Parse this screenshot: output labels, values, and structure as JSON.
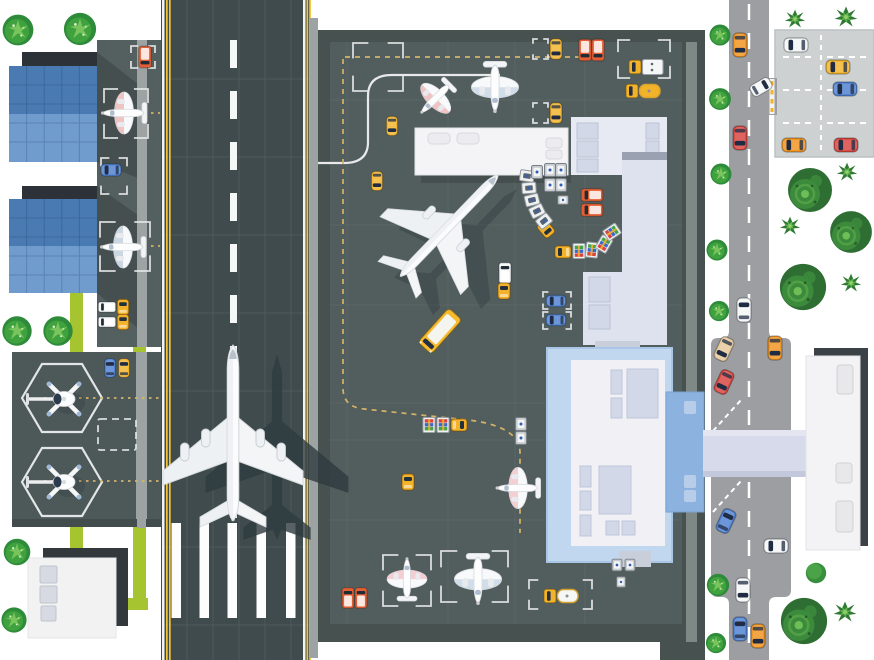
{
  "palette": {
    "bg": "#ffffff",
    "runway": "#3f4b4d",
    "runwayLine": "#4e5a5b",
    "runwayEdgeWhite": "#f2f3f3",
    "runwayEdgeYellow": "#f2c335",
    "apron": "#525d5d",
    "apronDark": "#47514f",
    "apronGrid": "#5d6868",
    "apronStrip": "#9da3a3",
    "pad": "#4d5859",
    "hangarRoofTop": "#4a7ab2",
    "hangarRoofBottom": "#6f9ccd",
    "hangarDark": "#2c3237",
    "lime": "#a6c430",
    "road": "#9c9ea1",
    "parking": "#cdd1d1",
    "terminal": "#e7eaf2",
    "terminalWing": "#dde2ee",
    "roofDetail": "#d2d8e7",
    "glass": "#c0d7ef",
    "atrium": "#8cb2e0",
    "bridge": "#d6daea",
    "shadowDark": "#3a4147",
    "marking": "#e8eaea",
    "taxiDash": "#d5b469",
    "vehicle": {
      "blue": "#4d7fd0",
      "yellow": "#f2b32a",
      "orange": "#f2921d",
      "red": "#d8433c",
      "orangeRed": "#e45e33",
      "white": "#f5f6f6",
      "tan": "#e6c79a",
      "busYellow": "#f6bb2e"
    }
  },
  "scene": {
    "trees": [
      {
        "k": "bush",
        "x": 18,
        "y": 30,
        "s": 1.1
      },
      {
        "k": "bush",
        "x": 80,
        "y": 29,
        "s": 1.15
      },
      {
        "k": "bush",
        "x": 17,
        "y": 331,
        "s": 1.05
      },
      {
        "k": "bush",
        "x": 58,
        "y": 331,
        "s": 1.05
      },
      {
        "k": "bush",
        "x": 17,
        "y": 552,
        "s": 0.95
      },
      {
        "k": "bush",
        "x": 14,
        "y": 620,
        "s": 0.9
      },
      {
        "k": "bush",
        "x": 720,
        "y": 35,
        "s": 0.75
      },
      {
        "k": "bush",
        "x": 720,
        "y": 99,
        "s": 0.78
      },
      {
        "k": "bush",
        "x": 721,
        "y": 174,
        "s": 0.75
      },
      {
        "k": "bush",
        "x": 717,
        "y": 250,
        "s": 0.75
      },
      {
        "k": "bush",
        "x": 719,
        "y": 311,
        "s": 0.72
      },
      {
        "k": "bush",
        "x": 718,
        "y": 585,
        "s": 0.8
      },
      {
        "k": "bush",
        "x": 716,
        "y": 643,
        "s": 0.72
      },
      {
        "k": "palm",
        "x": 795,
        "y": 19,
        "s": 0.85
      },
      {
        "k": "palm",
        "x": 846,
        "y": 17,
        "s": 0.95
      },
      {
        "k": "palm",
        "x": 847,
        "y": 172,
        "s": 0.85
      },
      {
        "k": "palm",
        "x": 790,
        "y": 226,
        "s": 0.85
      },
      {
        "k": "palm",
        "x": 851,
        "y": 283,
        "s": 0.85
      },
      {
        "k": "palm",
        "x": 845,
        "y": 612,
        "s": 0.95
      },
      {
        "k": "big",
        "x": 810,
        "y": 190,
        "s": 1
      },
      {
        "k": "big",
        "x": 851,
        "y": 232,
        "s": 0.95
      },
      {
        "k": "big",
        "x": 803,
        "y": 287,
        "s": 1.05
      },
      {
        "k": "big",
        "x": 804,
        "y": 621,
        "s": 1.05
      },
      {
        "k": "round",
        "x": 816,
        "y": 573,
        "s": 0.85
      }
    ],
    "vehicles": [
      {
        "k": "car",
        "x": 740,
        "y": 45,
        "r": 180,
        "c": "orange"
      },
      {
        "k": "car",
        "x": 740,
        "y": 138,
        "r": 180,
        "c": "red"
      },
      {
        "k": "car",
        "x": 744,
        "y": 310,
        "r": 0,
        "c": "white"
      },
      {
        "k": "car",
        "x": 724,
        "y": 349,
        "r": 205,
        "c": "tan"
      },
      {
        "k": "car",
        "x": 775,
        "y": 348,
        "r": 180,
        "c": "orange"
      },
      {
        "k": "car",
        "x": 724,
        "y": 382,
        "r": 205,
        "c": "red"
      },
      {
        "k": "car",
        "x": 726,
        "y": 521,
        "r": 25,
        "c": "blue"
      },
      {
        "k": "car",
        "x": 776,
        "y": 546,
        "r": 270,
        "c": "white"
      },
      {
        "k": "car",
        "x": 743,
        "y": 590,
        "r": 180,
        "c": "white"
      },
      {
        "k": "car",
        "x": 740,
        "y": 629,
        "r": 0,
        "c": "blue"
      },
      {
        "k": "car",
        "x": 758,
        "y": 636,
        "r": 180,
        "c": "orange"
      },
      {
        "k": "car",
        "x": 796,
        "y": 45,
        "r": 270,
        "c": "white"
      },
      {
        "k": "car",
        "x": 838,
        "y": 67,
        "r": 270,
        "c": "yellow"
      },
      {
        "k": "car",
        "x": 845,
        "y": 89,
        "r": 270,
        "c": "blue"
      },
      {
        "k": "car",
        "x": 794,
        "y": 145,
        "r": 270,
        "c": "orange"
      },
      {
        "k": "car",
        "x": 846,
        "y": 145,
        "r": 270,
        "c": "red"
      },
      {
        "k": "car",
        "x": 761,
        "y": 87,
        "r": 60,
        "c": "white",
        "s": 0.9
      },
      {
        "k": "car",
        "x": 110,
        "y": 368,
        "r": 0,
        "c": "blue",
        "s": 0.78
      },
      {
        "k": "car",
        "x": 124,
        "y": 368,
        "r": 0,
        "c": "yellow",
        "s": 0.78
      },
      {
        "k": "van",
        "x": 145,
        "y": 57,
        "r": 180,
        "c": "orangeRed",
        "s": 0.9
      },
      {
        "k": "car",
        "x": 111,
        "y": 170,
        "r": 270,
        "c": "blue",
        "s": 0.85
      },
      {
        "k": "van",
        "x": 107,
        "y": 307,
        "r": 270,
        "c": "white",
        "s": 0.72
      },
      {
        "k": "tug",
        "x": 123,
        "y": 307,
        "r": 0,
        "c": "yellow",
        "s": 0.95
      },
      {
        "k": "van",
        "x": 107,
        "y": 322,
        "r": 270,
        "c": "white",
        "s": 0.72
      },
      {
        "k": "tug",
        "x": 123,
        "y": 322,
        "r": 0,
        "c": "yellow",
        "s": 0.95
      },
      {
        "k": "car",
        "x": 392,
        "y": 126,
        "r": 180,
        "c": "yellow",
        "s": 0.8
      },
      {
        "k": "car",
        "x": 377,
        "y": 181,
        "r": 180,
        "c": "yellow",
        "s": 0.8
      },
      {
        "k": "car",
        "x": 556,
        "y": 49,
        "r": 180,
        "c": "yellow",
        "s": 0.85
      },
      {
        "k": "car",
        "x": 556,
        "y": 113,
        "r": 180,
        "c": "yellow",
        "s": 0.85
      },
      {
        "k": "van",
        "x": 585,
        "y": 50,
        "r": 180,
        "c": "orangeRed",
        "s": 0.9
      },
      {
        "k": "van",
        "x": 598,
        "y": 50,
        "r": 180,
        "c": "orangeRed",
        "s": 0.9
      },
      {
        "k": "van",
        "x": 592,
        "y": 195,
        "r": 270,
        "c": "orangeRed",
        "s": 0.9
      },
      {
        "k": "van",
        "x": 592,
        "y": 210,
        "r": 270,
        "c": "orangeRed",
        "s": 0.9
      },
      {
        "k": "car",
        "x": 556,
        "y": 301,
        "r": 270,
        "c": "blue",
        "s": 0.82
      },
      {
        "k": "car",
        "x": 556,
        "y": 320,
        "r": 270,
        "c": "blue",
        "s": 0.82
      },
      {
        "k": "van",
        "x": 505,
        "y": 273,
        "r": 0,
        "c": "white",
        "s": 0.85
      },
      {
        "k": "tug",
        "x": 504,
        "y": 291,
        "r": 0,
        "c": "yellow"
      },
      {
        "k": "van",
        "x": 348,
        "y": 598,
        "r": 0,
        "c": "orangeRed",
        "s": 0.85
      },
      {
        "k": "van",
        "x": 361,
        "y": 598,
        "r": 0,
        "c": "orangeRed",
        "s": 0.85
      },
      {
        "k": "tug",
        "x": 408,
        "y": 482,
        "r": 0,
        "c": "yellow"
      },
      {
        "k": "bus",
        "x": 440,
        "y": 331,
        "r": 222,
        "c": "busYellow"
      },
      {
        "k": "truckBox",
        "x": 646,
        "y": 67,
        "r": 270,
        "c": "white"
      },
      {
        "k": "truckTank",
        "x": 643,
        "y": 91,
        "r": 270,
        "c": "yellow"
      },
      {
        "k": "truckTank",
        "x": 561,
        "y": 596,
        "r": 270,
        "c": "white"
      },
      {
        "k": "tug",
        "x": 546,
        "y": 229,
        "r": 140,
        "c": "yellow"
      },
      {
        "k": "cartW",
        "x": 527,
        "y": 176,
        "r": 8
      },
      {
        "k": "cartW",
        "x": 529,
        "y": 188,
        "r": -4
      },
      {
        "k": "cartW",
        "x": 532,
        "y": 200,
        "r": -14
      },
      {
        "k": "cartW",
        "x": 537,
        "y": 211,
        "r": -26
      },
      {
        "k": "cartW",
        "x": 544,
        "y": 221,
        "r": -38
      },
      {
        "k": "tug",
        "x": 563,
        "y": 252,
        "r": 270,
        "c": "yellow"
      },
      {
        "k": "cartB",
        "x": 579,
        "y": 251,
        "r": 270
      },
      {
        "k": "cartB",
        "x": 592,
        "y": 250,
        "r": 276
      },
      {
        "k": "cartB",
        "x": 604,
        "y": 244,
        "r": 300
      },
      {
        "k": "cartB",
        "x": 612,
        "y": 232,
        "r": 326
      },
      {
        "k": "cartB",
        "x": 429,
        "y": 425,
        "r": 90
      },
      {
        "k": "cartB",
        "x": 443,
        "y": 425,
        "r": 90
      },
      {
        "k": "tug",
        "x": 459,
        "y": 425,
        "r": 90,
        "c": "yellow"
      },
      {
        "k": "container",
        "x": 537,
        "y": 172
      },
      {
        "k": "container",
        "x": 550,
        "y": 170
      },
      {
        "k": "container",
        "x": 561,
        "y": 170
      },
      {
        "k": "container",
        "x": 550,
        "y": 185
      },
      {
        "k": "container",
        "x": 561,
        "y": 185
      },
      {
        "k": "container",
        "x": 563,
        "y": 200,
        "r": 90,
        "s": 0.8
      },
      {
        "k": "container",
        "x": 521,
        "y": 424
      },
      {
        "k": "container",
        "x": 521,
        "y": 438
      },
      {
        "k": "container",
        "x": 617,
        "y": 565,
        "s": 0.9
      },
      {
        "k": "container",
        "x": 630,
        "y": 565,
        "s": 0.9
      },
      {
        "k": "container",
        "x": 621,
        "y": 582,
        "s": 0.8
      }
    ],
    "planes": [
      {
        "k": "jetShadow",
        "x": 277,
        "y": 446,
        "r": 0,
        "s": 1.02,
        "o": 0.8
      },
      {
        "k": "jet4",
        "x": 233,
        "y": 437,
        "r": 0,
        "s": 1
      },
      {
        "k": "jetShadow",
        "x": 466,
        "y": 242,
        "r": 44,
        "s": 0.82,
        "o": 0.4
      },
      {
        "k": "jet2",
        "x": 447,
        "y": 228,
        "r": 44,
        "s": 0.8
      },
      {
        "k": "planeS",
        "x": 126,
        "y": 113,
        "r": 270,
        "s": 1,
        "c": "#e59090"
      },
      {
        "k": "planeS",
        "x": 125,
        "y": 247,
        "r": 270,
        "s": 1,
        "c": "#9db7cb"
      },
      {
        "k": "planeS",
        "x": 437,
        "y": 97,
        "r": 225,
        "s": 0.92,
        "c": "#e59090"
      },
      {
        "k": "planeS",
        "x": 495,
        "y": 85,
        "r": 180,
        "s": 1.12,
        "c": "#a9c3d8"
      },
      {
        "k": "planeS",
        "x": 520,
        "y": 488,
        "r": 270,
        "s": 0.98,
        "c": "#eda3ab"
      },
      {
        "k": "planeS",
        "x": 407,
        "y": 581,
        "r": 0,
        "s": 0.95,
        "c": "#eda3ab"
      },
      {
        "k": "planeS",
        "x": 478,
        "y": 577,
        "r": 180,
        "s": 1.12,
        "c": "#a9c3d8"
      },
      {
        "k": "heli",
        "x": 64,
        "y": 399,
        "r": 0,
        "s": 1
      },
      {
        "k": "heli",
        "x": 64,
        "y": 482,
        "r": 0,
        "s": 1
      }
    ],
    "stands": [
      {
        "x": 104,
        "y": 89,
        "w": 44,
        "h": 49
      },
      {
        "x": 100,
        "y": 222,
        "w": 50,
        "h": 49
      },
      {
        "x": 131,
        "y": 46,
        "w": 24,
        "h": 22
      },
      {
        "x": 101,
        "y": 158,
        "w": 26,
        "h": 36
      },
      {
        "x": 353,
        "y": 43,
        "w": 50,
        "h": 48
      },
      {
        "x": 618,
        "y": 40,
        "w": 52,
        "h": 38
      },
      {
        "x": 533,
        "y": 39,
        "w": 15,
        "h": 20
      },
      {
        "x": 533,
        "y": 103,
        "w": 15,
        "h": 20
      },
      {
        "x": 543,
        "y": 292,
        "w": 28,
        "h": 17
      },
      {
        "x": 543,
        "y": 312,
        "w": 28,
        "h": 17
      },
      {
        "x": 383,
        "y": 555,
        "w": 48,
        "h": 51
      },
      {
        "x": 441,
        "y": 551,
        "w": 67,
        "h": 51
      },
      {
        "x": 529,
        "y": 580,
        "w": 63,
        "h": 29
      },
      {
        "x": 98,
        "y": 419,
        "w": 38,
        "h": 31,
        "dash": true
      }
    ]
  }
}
